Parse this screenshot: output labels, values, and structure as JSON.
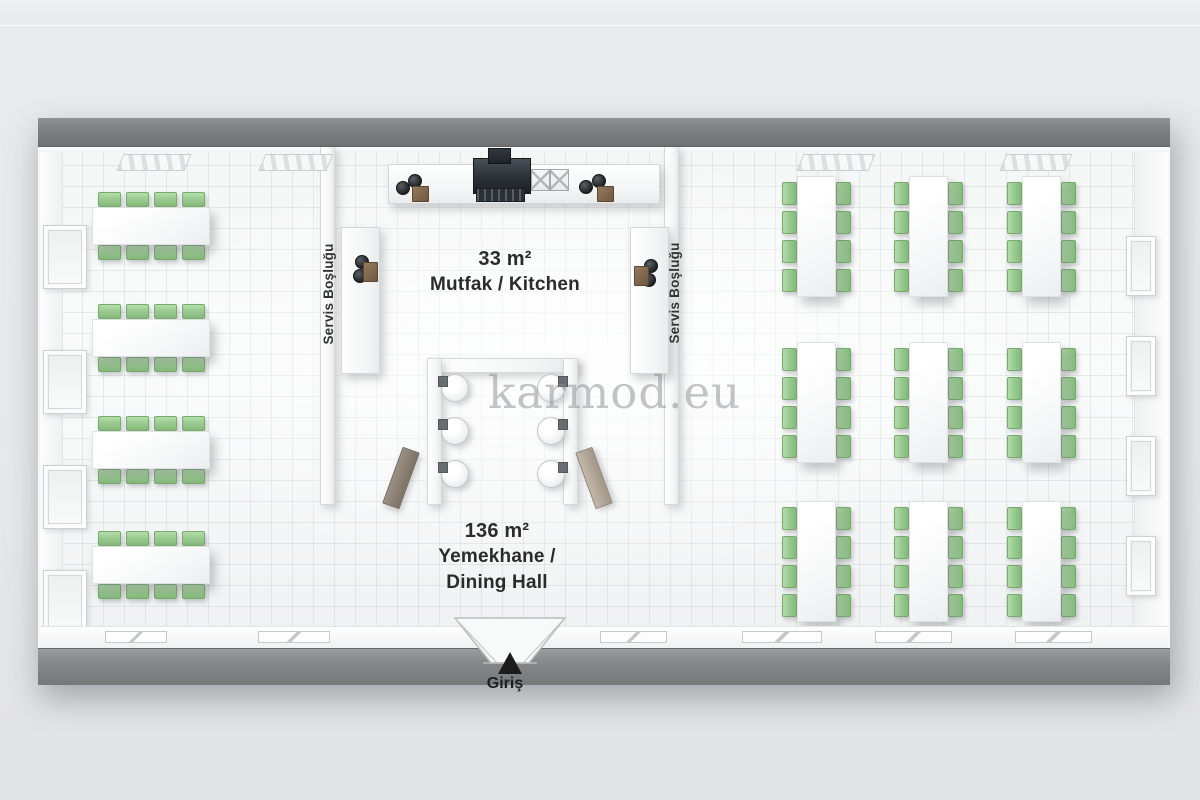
{
  "watermark": "karmod.eu",
  "rooms": {
    "kitchen": {
      "area_label": "33 m²",
      "name_label": "Mutfak / Kitchen"
    },
    "dining_hall": {
      "area_label": "136 m²",
      "name_line1": "Yemekhane /",
      "name_line2": "Dining Hall"
    },
    "service_gap_left": {
      "label": "Servis Boşluğu"
    },
    "service_gap_right": {
      "label": "Servis Boşluğu"
    }
  },
  "entrance": {
    "label": "Giriş"
  },
  "furniture": {
    "left_tables": {
      "orientation": "horizontal",
      "x": 52,
      "ys": [
        61,
        173,
        285,
        400
      ],
      "table_w": 116,
      "table_h": 36,
      "chairs_per_side": 4
    },
    "right_tables": {
      "orientation": "vertical",
      "xs": [
        757,
        869,
        982
      ],
      "ys": [
        30,
        196,
        355
      ],
      "table_w": 37,
      "table_h": 119,
      "chairs_per_side": 4
    },
    "washbasins": {
      "left_x": 401,
      "right_x": 497,
      "ys": [
        228,
        271,
        314
      ],
      "size": 26
    }
  },
  "colors": {
    "chair_green": "#96c88d",
    "fascia_gray": "#7d7f80",
    "board_brown": "#7f6a51",
    "hood_dark": "#2b3036",
    "floor_white": "#fafbfb"
  }
}
